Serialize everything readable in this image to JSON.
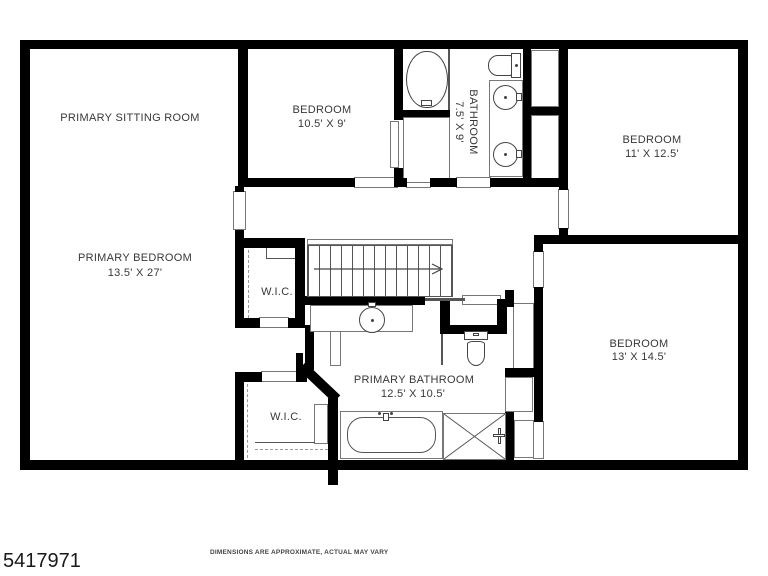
{
  "rooms": {
    "sitting": {
      "name": "PRIMARY SITTING ROOM"
    },
    "bedroom_top": {
      "name": "BEDROOM",
      "dims": "10.5' X 9'"
    },
    "bathroom_top": {
      "name": "BATHROOM",
      "dims": "7.5' X 9'"
    },
    "bedroom_right": {
      "name": "BEDROOM",
      "dims": "11' X 12.5'"
    },
    "primary_bedroom": {
      "name": "PRIMARY BEDROOM",
      "dims": "13.5' X 27'"
    },
    "wic_upper": {
      "name": "W.I.C."
    },
    "wic_lower": {
      "name": "W.I.C."
    },
    "primary_bathroom": {
      "name": "PRIMARY BATHROOM",
      "dims": "12.5' X 10.5'"
    },
    "bedroom_bottom_right": {
      "name": "BEDROOM",
      "dims": "13' X 14.5'"
    }
  },
  "footer": {
    "listing_id": "5417971",
    "disclaimer": "DIMENSIONS ARE APPROXIMATE, ACTUAL MAY VARY"
  },
  "colors": {
    "walls": "#000000",
    "thin_lines": "#555555",
    "label_text": "#383838",
    "background": "#ffffff"
  }
}
